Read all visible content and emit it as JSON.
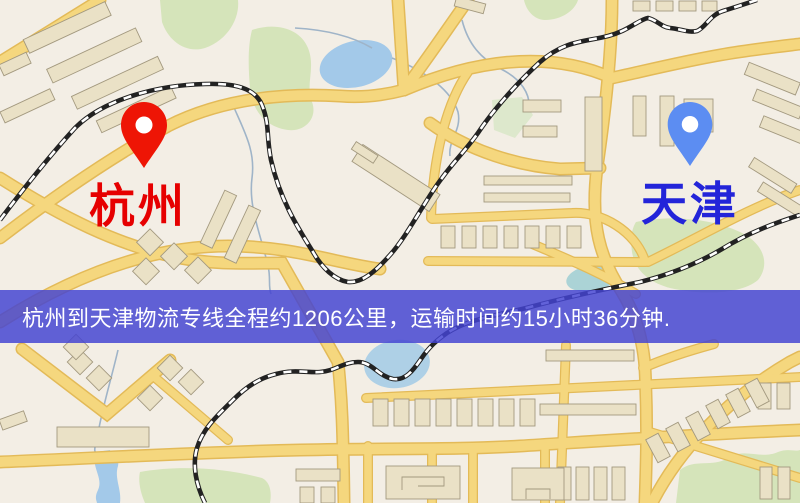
{
  "map": {
    "banner": {
      "text": "杭州到天津物流专线全程约1206公里，运输时间约15小时36分钟.",
      "bg_color": "#4444d2",
      "text_color": "#ffffff",
      "distance_km": 1206,
      "duration": "15小时36分钟"
    },
    "origin": {
      "name": "杭州",
      "pin_color": "#ee1505",
      "label_color": "#e60000"
    },
    "destination": {
      "name": "天津",
      "pin_color": "#5c8df2",
      "label_color": "#2324d9"
    },
    "map_colors": {
      "land": "#f3eee5",
      "road_fill": "#f5d77e",
      "road_edge": "#e3ba58",
      "building": "#eae1c6",
      "building_edge": "#a3997f",
      "green": "#d5e4ba",
      "water": "#a3c9e9",
      "railway": "#222222"
    }
  }
}
